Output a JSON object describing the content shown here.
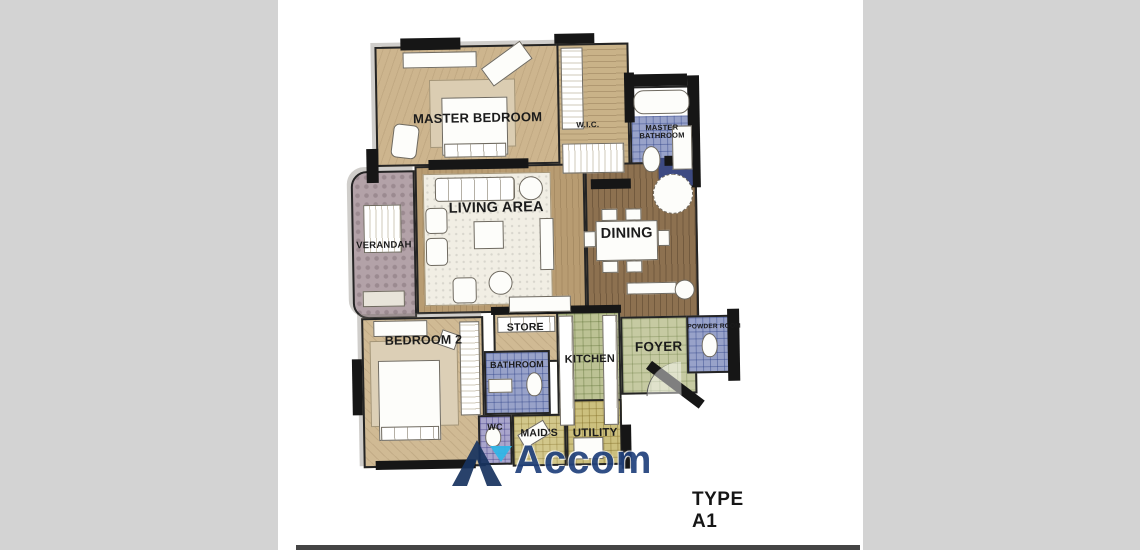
{
  "title": {
    "text": "TYPE A1"
  },
  "watermark": {
    "brand": "Accom",
    "logo_letter": "A",
    "navy": "#17335f",
    "cyan": "#2fb7e8"
  },
  "rooms": {
    "master_bedroom": {
      "label": "MASTER BEDROOM"
    },
    "wic": {
      "label": "W.I.C."
    },
    "master_bathroom": {
      "label": "MASTER BATHROOM"
    },
    "living_area": {
      "label": "LIVING AREA"
    },
    "dining": {
      "label": "DINING"
    },
    "verandah": {
      "label": "VERANDAH"
    },
    "store": {
      "label": "STORE"
    },
    "kitchen": {
      "label": "KITCHEN"
    },
    "foyer": {
      "label": "FOYER"
    },
    "powder_room": {
      "label": "POWDER ROOM"
    },
    "bedroom_2": {
      "label": "BEDROOM 2"
    },
    "bathroom": {
      "label": "BATHROOM"
    },
    "wc": {
      "label": "WC"
    },
    "maids": {
      "label": "MAID'S"
    },
    "utility": {
      "label": "UTILITY"
    }
  },
  "colors": {
    "side_gray": "#d3d3d3",
    "wall_black": "#161616",
    "floor_tan": "#cdb58e",
    "wood_brown": "#8d7150",
    "tile_blue": "#98a2c9",
    "tile_green": "#bcc294",
    "tile_khaki": "#ccc07e",
    "verandah_mauve": "#b3a2a8",
    "dark_tile_blue": "#3d4a82",
    "title_text": "#161616"
  }
}
